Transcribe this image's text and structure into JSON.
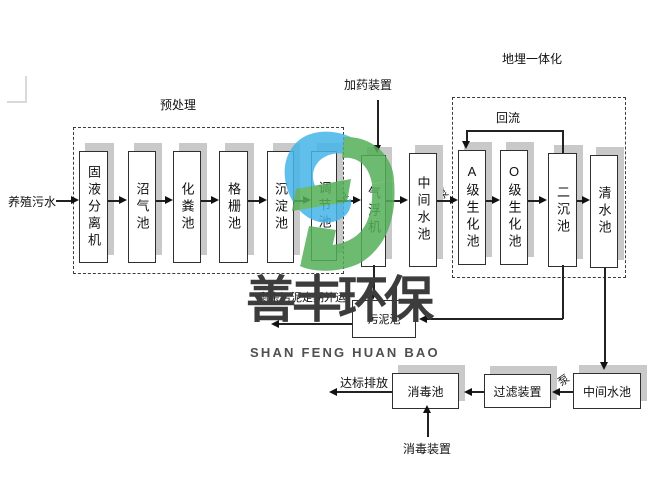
{
  "process": {
    "source": "养殖污水",
    "section_labels": {
      "pretreatment": "预处理",
      "buried_integrated": "地埋一体化"
    },
    "dosing_device": "加药装置",
    "reflux": "回流",
    "pump": "泵",
    "tanks": {
      "separator": "固液分离机",
      "biogas": "沼气池",
      "septic": "化粪池",
      "grid": "格栅池",
      "sedimentation": "沉淀池",
      "regulating": "调节池",
      "flotation": "气浮机",
      "mid1": "中间水池",
      "a_bio": "A级生化池",
      "o_bio": "O级生化池",
      "secondary": "二沉池",
      "clear": "清水池",
      "sludge": "污泥池",
      "mid2": "中间水池",
      "filter": "过滤装置",
      "disinfect": "消毒池"
    },
    "notes": {
      "sludge_out": "剩余污泥定期外运",
      "discharge": "达标排放",
      "disinfect_device": "消毒装置"
    }
  },
  "watermark": {
    "cn": "善丰环保",
    "en": "SHAN FENG HUAN BAO",
    "blue": "#45b5e8",
    "green": "#53b058",
    "text_color": "#3c3c3c"
  }
}
